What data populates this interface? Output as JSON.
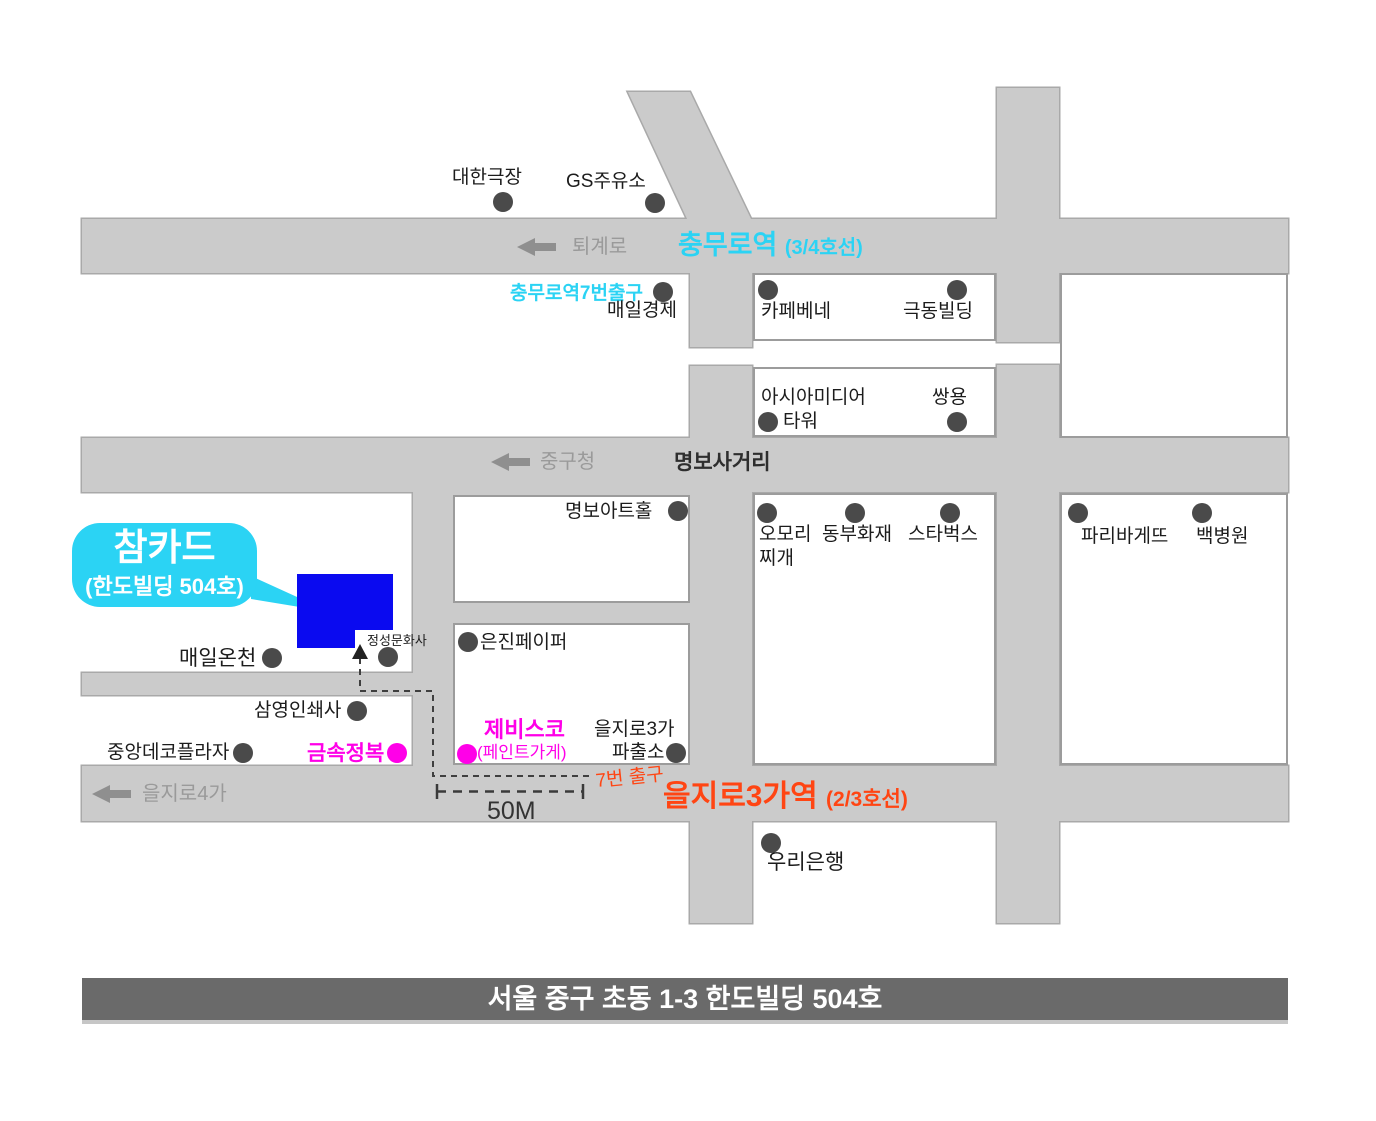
{
  "colors": {
    "road_fill": "#cbcbcb",
    "road_border": "#a9a9a9",
    "block_border": "#9c9c9c",
    "cyan_accent": "#2bd3f4",
    "red_accent": "#ff4513",
    "magenta_accent": "#ff00e8",
    "building_blue": "#0a0af0",
    "footer_bar": "#6a6a6a",
    "dot": "#4a4a4a"
  },
  "streets": {
    "toegyero": "퇴계로",
    "junggucheong": "중구청",
    "myeongbo_junction": "명보사거리",
    "euljiro4ga": "을지로4가"
  },
  "stations": {
    "chungmuro_name": "충무로역",
    "chungmuro_line": "(3/4호선)",
    "chungmuro_exit7": "충무로역7번출구",
    "euljiro3ga_name": "을지로3가역",
    "euljiro3ga_line": "(2/3호선)",
    "exit7": "7번 출구",
    "distance": "50M"
  },
  "landmarks": {
    "daehan_theater": "대한극장",
    "gs_station": "GS주유소",
    "maeil_business": "매일경제",
    "caffebene": "카페베네",
    "geukdong_building": "극동빌딩",
    "asia_media": "아시아미디어",
    "asia_media_tower": "타워",
    "ssangyong": "쌍용",
    "myeongbo_art_hall": "명보아트홀",
    "omori": "오모리",
    "omori_jjigae": "찌개",
    "dongbu_insurance": "동부화재",
    "starbucks": "스타벅스",
    "paris_baguette": "파리바게뜨",
    "baek_hospital": "백병원",
    "maeil_oncheon": "매일온천",
    "jeongseong_munhwasa": "정성문화사",
    "samyeong_printing": "삼영인쇄사",
    "jungang_deco_plaza": "중앙데코플라자",
    "geumsok_jeongbok": "금속정복",
    "eunjin_paper": "은진페이퍼",
    "jebisco": "제비스코",
    "jebisco_note": "(페인트가게)",
    "euljiro3ga_police_line1": "을지로3가",
    "euljiro3ga_police_line2": "파출소",
    "woori_bank": "우리은행"
  },
  "callout": {
    "title": "참카드",
    "subtitle": "(한도빌딩 504호)"
  },
  "footer": {
    "address": "서울 중구 초동 1-3 한도빌딩 504호"
  }
}
